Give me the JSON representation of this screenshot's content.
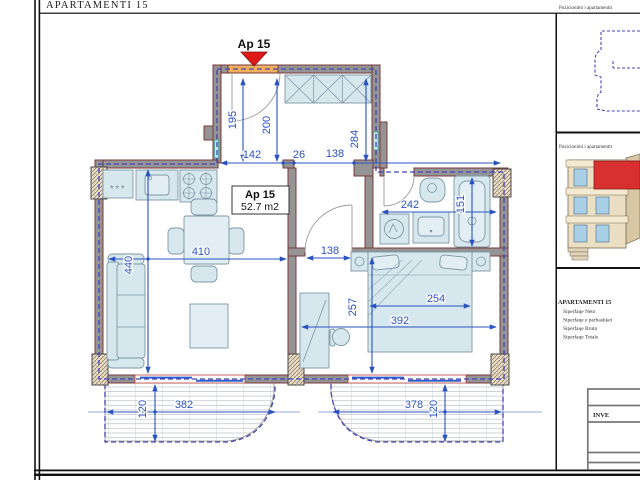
{
  "sheet": {
    "title": "APARTAMENTI 15",
    "panel1_title": "Pozicionimi i apartamentit",
    "panel2_title": "Pozicionimi i apartamentit",
    "info_title": "APARTAMENTI 15",
    "info_rows": [
      "Siperfaqe Neto",
      "Siperfaqe e perbashket",
      "Siperfaqe Bruto",
      "Siperfaqe Totale"
    ],
    "titleblock_text": "INVE"
  },
  "plan": {
    "marker_label": "Ap 15",
    "room_label": "Ap 15",
    "room_area": "52.7 m2",
    "kitchen_symbol": "***",
    "dims": {
      "entry_left": "195",
      "entry_door": "200",
      "top_a": "142",
      "top_b": "26",
      "top_c": "138",
      "hall": "284",
      "living_w": "410",
      "living_h": "440",
      "bath_w": "242",
      "bath_h": "151",
      "corridor": "138",
      "bed_w": "254",
      "bedroom_w": "392",
      "bedroom_h": "257",
      "balcony_l_w": "382",
      "balcony_l_d": "120",
      "balcony_r_w": "378",
      "balcony_r_d": "120"
    }
  },
  "colors": {
    "dimension_blue": "#2b53c0",
    "boundary_blue": "#4343b6",
    "wall_gray": "#949494",
    "wall_stroke": "#7a3a3a",
    "entry_door_orange": "#f0b060",
    "marker_red": "#e01818",
    "furniture_blue": "#d6e7ee"
  }
}
